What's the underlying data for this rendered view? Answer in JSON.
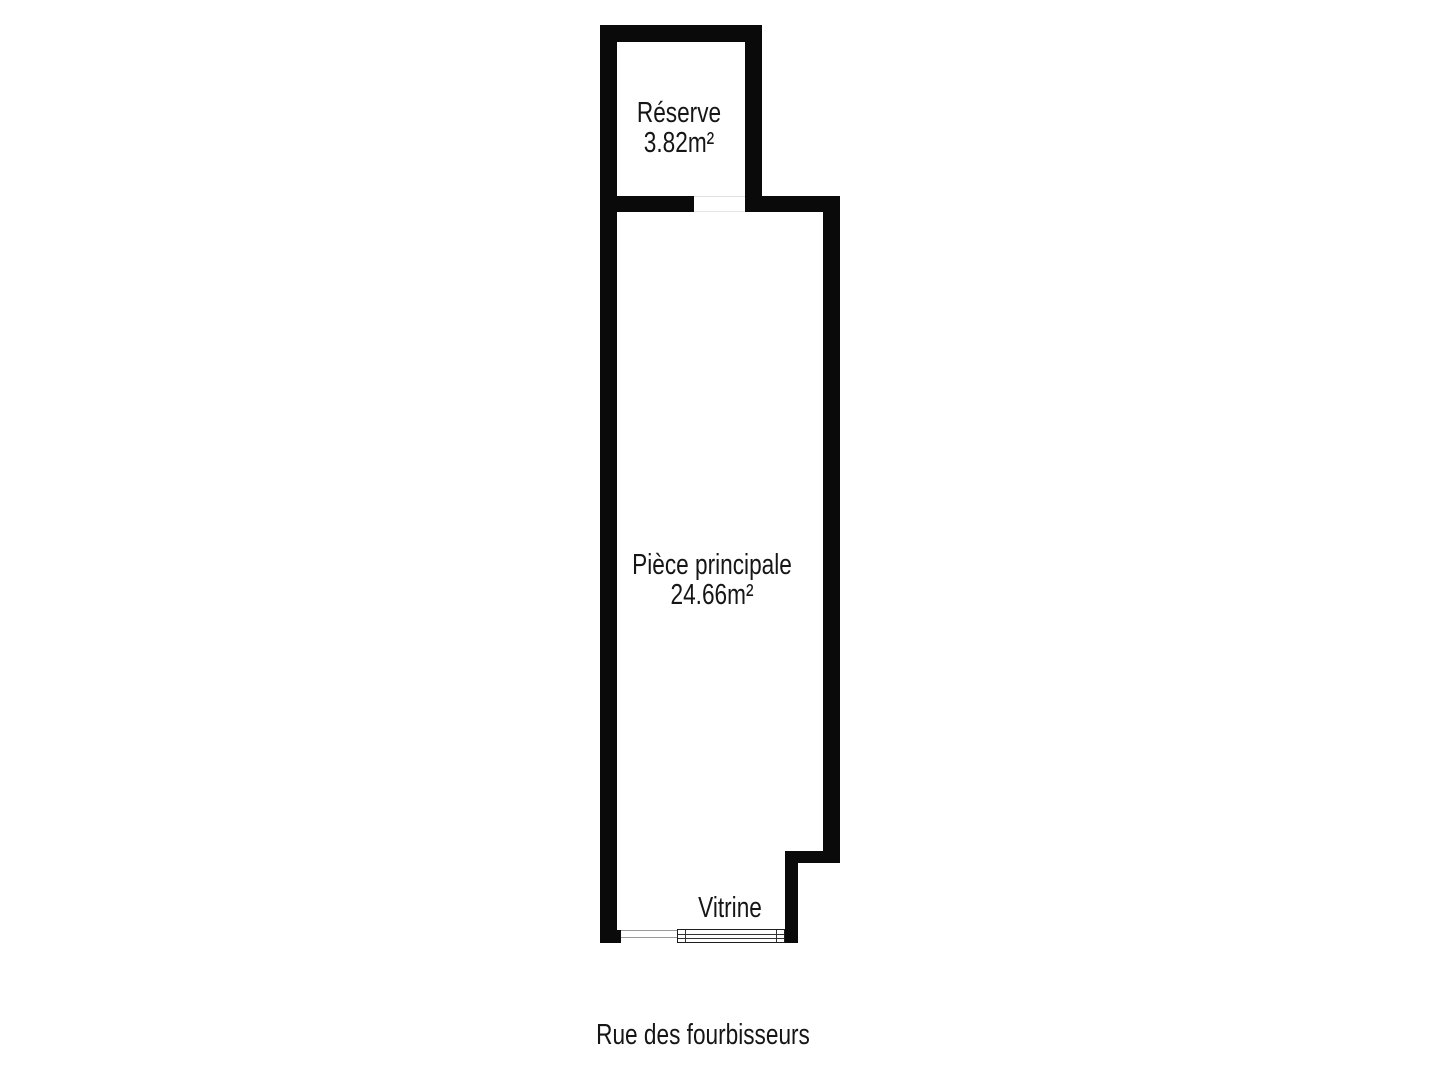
{
  "plan": {
    "rooms": [
      {
        "name": "Réserve",
        "area": "3.82m²"
      },
      {
        "name": "Pièce principale",
        "area": "24.66m²"
      }
    ],
    "vitrine_label": "Vitrine",
    "street_label": "Rue des fourbisseurs"
  },
  "colors": {
    "wall": "#0a0a0a",
    "text": "#161616",
    "background": "#ffffff",
    "opening_line_light": "#e0e0e0",
    "opening_line_dark": "#9a9a9a",
    "window_border": "#1f1f1f"
  }
}
